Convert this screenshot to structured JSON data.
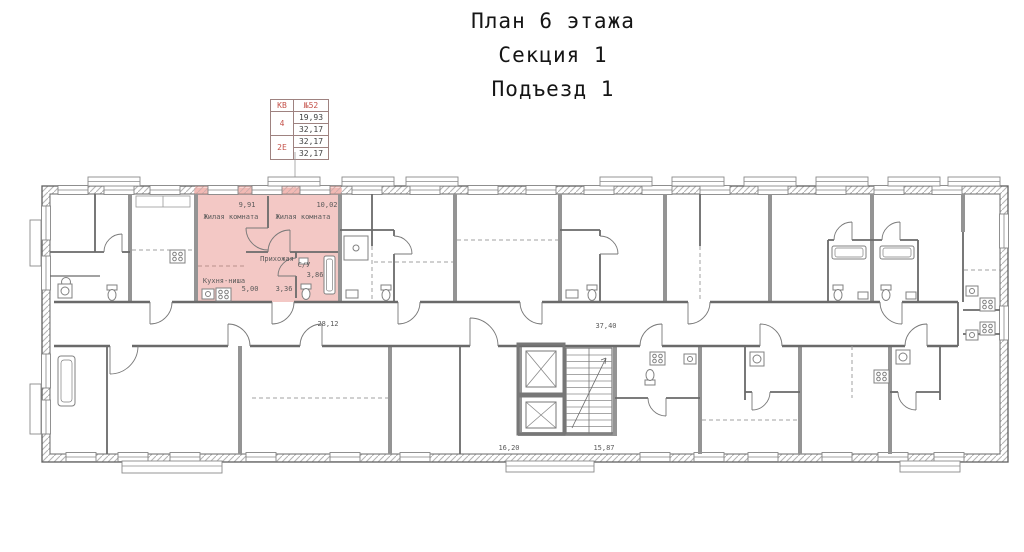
{
  "title": {
    "lines": [
      "План 6 этажа",
      "Секция 1",
      "Подъезд 1"
    ]
  },
  "info_table": {
    "header_left": "КВ",
    "header_right": "№52",
    "rows": [
      {
        "label": "4",
        "values": [
          "19,93",
          "32,17"
        ]
      },
      {
        "label": "2Е",
        "values": [
          "32,17",
          "32,17"
        ]
      }
    ]
  },
  "apartment": {
    "number": "КВ №52",
    "highlight_color": "#f3c8c5",
    "rooms": [
      {
        "name": "Жилая комната",
        "area": "9,91"
      },
      {
        "name": "Жилая комната",
        "area": "10,02"
      },
      {
        "name": "Прихожая",
        "area": "3,36"
      },
      {
        "name": "Кухня-ниша",
        "area": "5,00"
      },
      {
        "name": "С/У",
        "area": "3,86"
      }
    ]
  },
  "common_areas": {
    "corridor_left": "28,12",
    "corridor_right": "37,40",
    "hall_left": "16,20",
    "hall_right": "15,87"
  },
  "colors": {
    "accent_red": "#c4524a",
    "highlight": "#f3c8c5",
    "wall_line": "#6a6a6a"
  }
}
